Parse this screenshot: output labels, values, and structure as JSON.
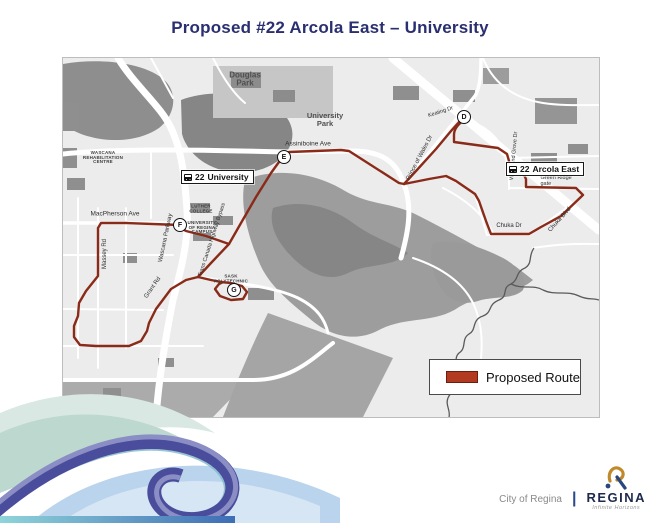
{
  "title": "Proposed #22 Arcola East – University",
  "colors": {
    "title": "#2a2f70",
    "route": "#8a2a18",
    "legend_swatch": "#b23a20",
    "map_background": "#ececec",
    "park_gray": "#9d9d9d"
  },
  "legend": {
    "label": "Proposed Route"
  },
  "map": {
    "badges": [
      {
        "route_num": "22",
        "label": "University",
        "x": 118,
        "y": 112,
        "icon": "bus-icon"
      },
      {
        "route_num": "22",
        "label": "Arcola East",
        "x": 443,
        "y": 104,
        "icon": "bus-icon"
      }
    ],
    "stops": [
      {
        "letter": "D",
        "x": 401,
        "y": 59
      },
      {
        "letter": "E",
        "x": 221,
        "y": 99
      },
      {
        "letter": "F",
        "x": 117,
        "y": 167
      },
      {
        "letter": "G",
        "x": 171,
        "y": 232
      }
    ],
    "labels": [
      {
        "text": "Douglas\nPark",
        "x": 182,
        "y": 22,
        "size": 8,
        "cls": "area"
      },
      {
        "text": "University\nPark",
        "x": 262,
        "y": 62,
        "size": 7.5,
        "cls": "area"
      },
      {
        "text": "Assiniboine Ave",
        "x": 245,
        "y": 87,
        "size": 6.5,
        "cls": "street"
      },
      {
        "text": "MacPherson Ave",
        "x": 52,
        "y": 157,
        "size": 6.5,
        "cls": "street"
      },
      {
        "text": "Massey Rd",
        "x": 42,
        "y": 196,
        "size": 6,
        "rot": -90,
        "cls": "street"
      },
      {
        "text": "Wascana Parkway",
        "x": 103,
        "y": 180,
        "size": 6,
        "rot": -78,
        "cls": "street"
      },
      {
        "text": "Trans Canada Highway Bypass",
        "x": 150,
        "y": 182,
        "size": 5.5,
        "rot": -72,
        "cls": "street"
      },
      {
        "text": "Grant Rd",
        "x": 90,
        "y": 230,
        "size": 6,
        "rot": -55,
        "cls": "street"
      },
      {
        "text": "WASCANA\nREHABILITATION\nCENTRE",
        "x": 40,
        "y": 100,
        "size": 4.5,
        "cls": "poi"
      },
      {
        "text": "LUTHER\nCOLLEGE",
        "x": 138,
        "y": 151,
        "size": 4.5,
        "cls": "poi"
      },
      {
        "text": "UNIVERSITY\nOF REGINA\nCAMPUS",
        "x": 139,
        "y": 170,
        "size": 4.5,
        "cls": "poi"
      },
      {
        "text": "SASK\nPOLYTECHNIC",
        "x": 168,
        "y": 221,
        "size": 4.5,
        "cls": "poi"
      },
      {
        "text": "Keating Dr",
        "x": 378,
        "y": 55,
        "size": 5.5,
        "rot": -18,
        "cls": "street"
      },
      {
        "text": "Prince of Wales Dr",
        "x": 357,
        "y": 100,
        "size": 6,
        "rot": -62,
        "cls": "street"
      },
      {
        "text": "Woodland Grove Dr",
        "x": 452,
        "y": 98,
        "size": 5.5,
        "rot": -85,
        "cls": "street"
      },
      {
        "text": "Green Ridge gate",
        "x": 497,
        "y": 124,
        "size": 5.5,
        "cls": "street"
      },
      {
        "text": "Chuka Blvd",
        "x": 497,
        "y": 162,
        "size": 6,
        "rot": -48,
        "cls": "street"
      },
      {
        "text": "Chuka Dr",
        "x": 446,
        "y": 168,
        "size": 6,
        "cls": "street"
      }
    ]
  },
  "footer": {
    "city_label": "City of Regina",
    "wordmark": "REGINA",
    "tagline": "Infinite Horizons"
  }
}
